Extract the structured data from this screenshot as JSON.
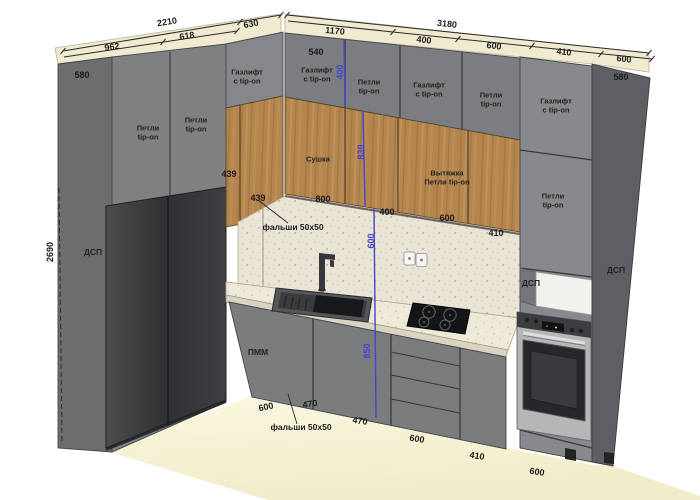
{
  "drawing": {
    "kind": "kitchen-corner-3d-elevation",
    "units": "mm"
  },
  "colors": {
    "dimension_blue": "#4444cd",
    "annotation_text": "#1c1c1c",
    "cabinet_gray": "#7e8082",
    "wood": "#b5854e",
    "fridge_dark": "#35363a",
    "worktop": "#ece8d8",
    "backsplash": "#e9e4d5",
    "floor": "#f7f3d6",
    "crown": "#f0ead0"
  },
  "annotations": {
    "width_dims": [
      {
        "text": "2210",
        "x": 167,
        "y": 22,
        "rot": -9
      },
      {
        "text": "630",
        "x": 251,
        "y": 24,
        "rot": -11
      },
      {
        "text": "962",
        "x": 112,
        "y": 47,
        "rot": -9
      },
      {
        "text": "618",
        "x": 187,
        "y": 36,
        "rot": -9
      },
      {
        "text": "3180",
        "x": 447,
        "y": 24,
        "rot": 6
      },
      {
        "text": "1170",
        "x": 335,
        "y": 31,
        "rot": 5
      },
      {
        "text": "400",
        "x": 424,
        "y": 40,
        "rot": 6
      },
      {
        "text": "600",
        "x": 494,
        "y": 46,
        "rot": 6
      },
      {
        "text": "410",
        "x": 564,
        "y": 52,
        "rot": 6
      },
      {
        "text": "600",
        "x": 624,
        "y": 59,
        "rot": 6
      },
      {
        "text": "580",
        "x": 82,
        "y": 75,
        "rot": 0
      },
      {
        "text": "540",
        "x": 316,
        "y": 52,
        "rot": 0
      },
      {
        "text": "580",
        "x": 621,
        "y": 77,
        "rot": 0
      },
      {
        "text": "439",
        "x": 229,
        "y": 174,
        "rot": 0
      },
      {
        "text": "439",
        "x": 258,
        "y": 198,
        "rot": 0
      },
      {
        "text": "800",
        "x": 323,
        "y": 199,
        "rot": 0
      },
      {
        "text": "400",
        "x": 387,
        "y": 212,
        "rot": 0
      },
      {
        "text": "600",
        "x": 447,
        "y": 218,
        "rot": 0
      },
      {
        "text": "410",
        "x": 496,
        "y": 233,
        "rot": 0
      },
      {
        "text": "2690",
        "x": 50,
        "y": 252,
        "rot": -90
      }
    ],
    "height_dims_blue": [
      {
        "text": "400",
        "x": 340,
        "y": 72,
        "rot": -90
      },
      {
        "text": "830",
        "x": 361,
        "y": 152,
        "rot": -90
      },
      {
        "text": "600",
        "x": 371,
        "y": 241,
        "rot": -90
      },
      {
        "text": "850",
        "x": 367,
        "y": 351,
        "rot": -90
      }
    ],
    "floor_dims": [
      {
        "text": "600",
        "x": 266,
        "y": 407,
        "rot": -12
      },
      {
        "text": "470",
        "x": 310,
        "y": 404,
        "rot": -8
      },
      {
        "text": "470",
        "x": 360,
        "y": 421,
        "rot": 8
      },
      {
        "text": "600",
        "x": 417,
        "y": 439,
        "rot": 9
      },
      {
        "text": "410",
        "x": 477,
        "y": 456,
        "rot": 9
      },
      {
        "text": "600",
        "x": 537,
        "y": 472,
        "rot": 9
      }
    ],
    "cabinet_labels": [
      {
        "text": "Петли\ntip-on",
        "x": 148,
        "y": 133,
        "rot": 0
      },
      {
        "text": "Петли\ntip-on",
        "x": 196,
        "y": 125,
        "rot": 0
      },
      {
        "text": "Газлифт\nс tip-on",
        "x": 247,
        "y": 77,
        "rot": 0
      },
      {
        "text": "Газлифт\nс tip-on",
        "x": 317,
        "y": 75,
        "rot": 0
      },
      {
        "text": "Петли\ntip-on",
        "x": 369,
        "y": 87,
        "rot": 0
      },
      {
        "text": "Газлифт\nс tip-on",
        "x": 429,
        "y": 90,
        "rot": 0
      },
      {
        "text": "Петли\ntip-on",
        "x": 491,
        "y": 100,
        "rot": 0
      },
      {
        "text": "Газлифт\nс tip-on",
        "x": 556,
        "y": 106,
        "rot": 0
      },
      {
        "text": "Петли\ntip-on",
        "x": 553,
        "y": 201,
        "rot": 0
      },
      {
        "text": "Сушка",
        "x": 318,
        "y": 160,
        "rot": 0
      },
      {
        "text": "Вытяжка\nПетли tip-on",
        "x": 447,
        "y": 178,
        "rot": 0
      }
    ],
    "panel_labels": [
      {
        "text": "ДСП",
        "x": 93,
        "y": 253,
        "rot": 0
      },
      {
        "text": "ДСП",
        "x": 616,
        "y": 271,
        "rot": 0
      },
      {
        "text": "ДСП",
        "x": 531,
        "y": 284,
        "rot": 0
      }
    ],
    "appliance_labels": [
      {
        "text": "ПММ",
        "x": 258,
        "y": 353,
        "rot": 0
      }
    ],
    "note_labels": [
      {
        "text": "фальши 50х50",
        "x": 293,
        "y": 228,
        "rot": 0
      },
      {
        "text": "фальши 50х50",
        "x": 301,
        "y": 428,
        "rot": 0
      }
    ]
  }
}
